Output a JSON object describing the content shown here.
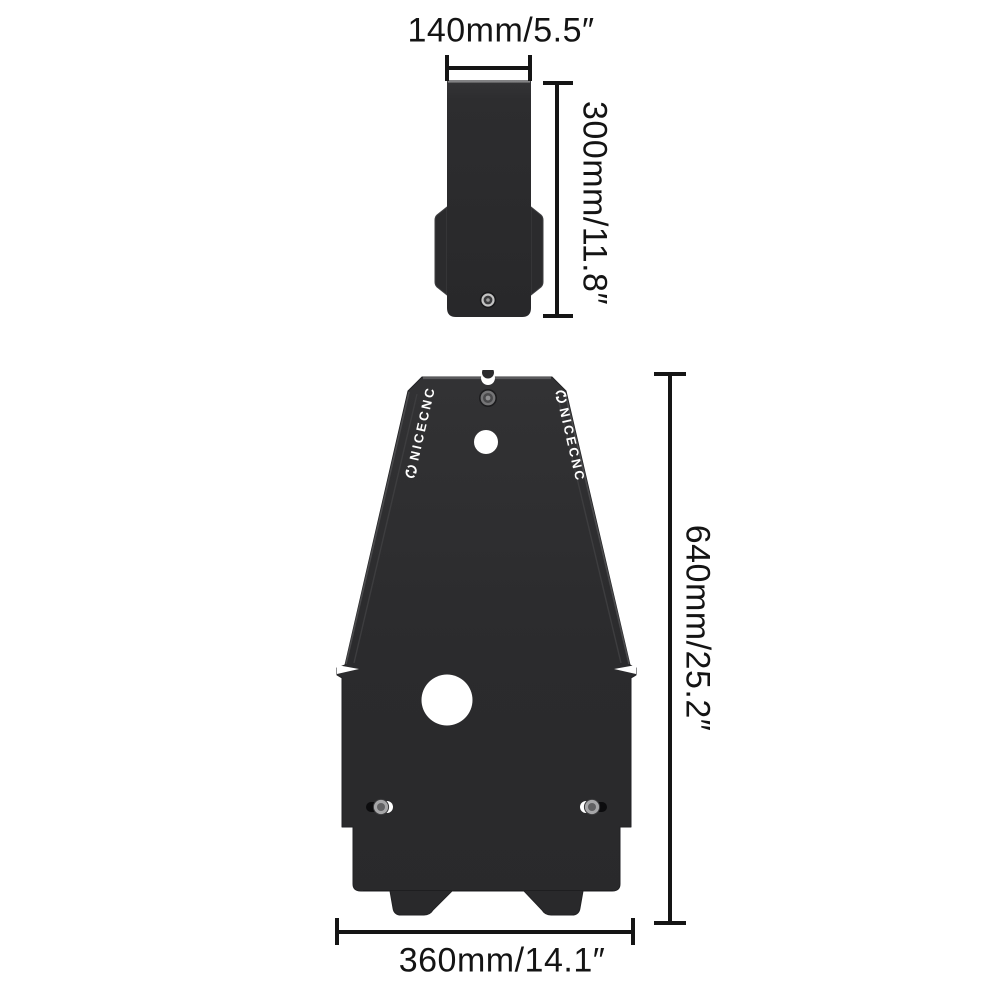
{
  "brand": {
    "name": "NICECNC"
  },
  "colors": {
    "background": "#ffffff",
    "part_fill": "#2b2b2d",
    "dimension_line": "#151515",
    "label_text": "#141414",
    "logo_text": "#ffffff"
  },
  "parts": {
    "bracket": {
      "title": "front bracket plate",
      "width": {
        "label": "140mm/5.5″"
      },
      "height": {
        "label": "300mm/11.8″"
      }
    },
    "skid_plate": {
      "title": "main skid plate",
      "height": {
        "label": "640mm/25.2″"
      },
      "width": {
        "label": "360mm/14.1″"
      }
    }
  }
}
